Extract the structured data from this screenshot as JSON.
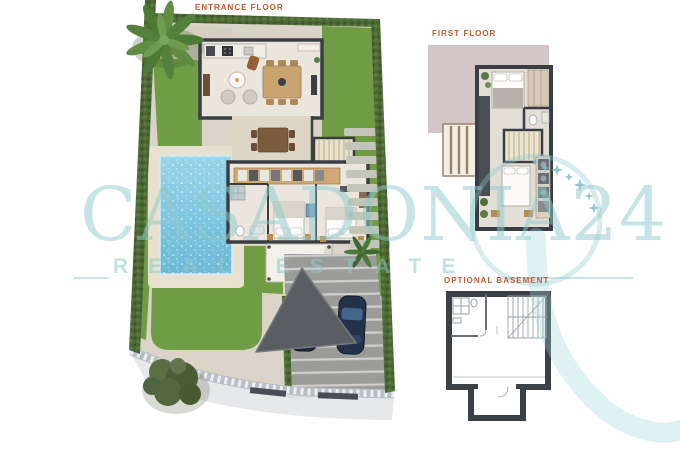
{
  "plan_labels": {
    "entrance_floor": "ENTRANCE FLOOR",
    "first_floor": "FIRST FLOOR",
    "optional_basement": "OPTIONAL BASEMENT"
  },
  "watermark": {
    "brand": "CASADONIA24",
    "tagline": "REAL ESTATE",
    "icons": [
      "four-point-star",
      "ring",
      "swoosh"
    ]
  },
  "colors": {
    "label-orange": "#bf5c36",
    "watermark-teal": "#8fc9cc",
    "lawn-green": "#6f9c44",
    "hedge-green": "#4e6b36",
    "pool-blue": "#7cc5df",
    "deck-beige": "#e8e0d1",
    "paving-grey": "#d9d4c7",
    "driveway-grey": "#9b9b99",
    "wall-dark": "#3a3e44",
    "floor-beige": "#eae6de",
    "terrace-mauve": "#d2c6c7",
    "sail-grey": "#5a5d61"
  }
}
